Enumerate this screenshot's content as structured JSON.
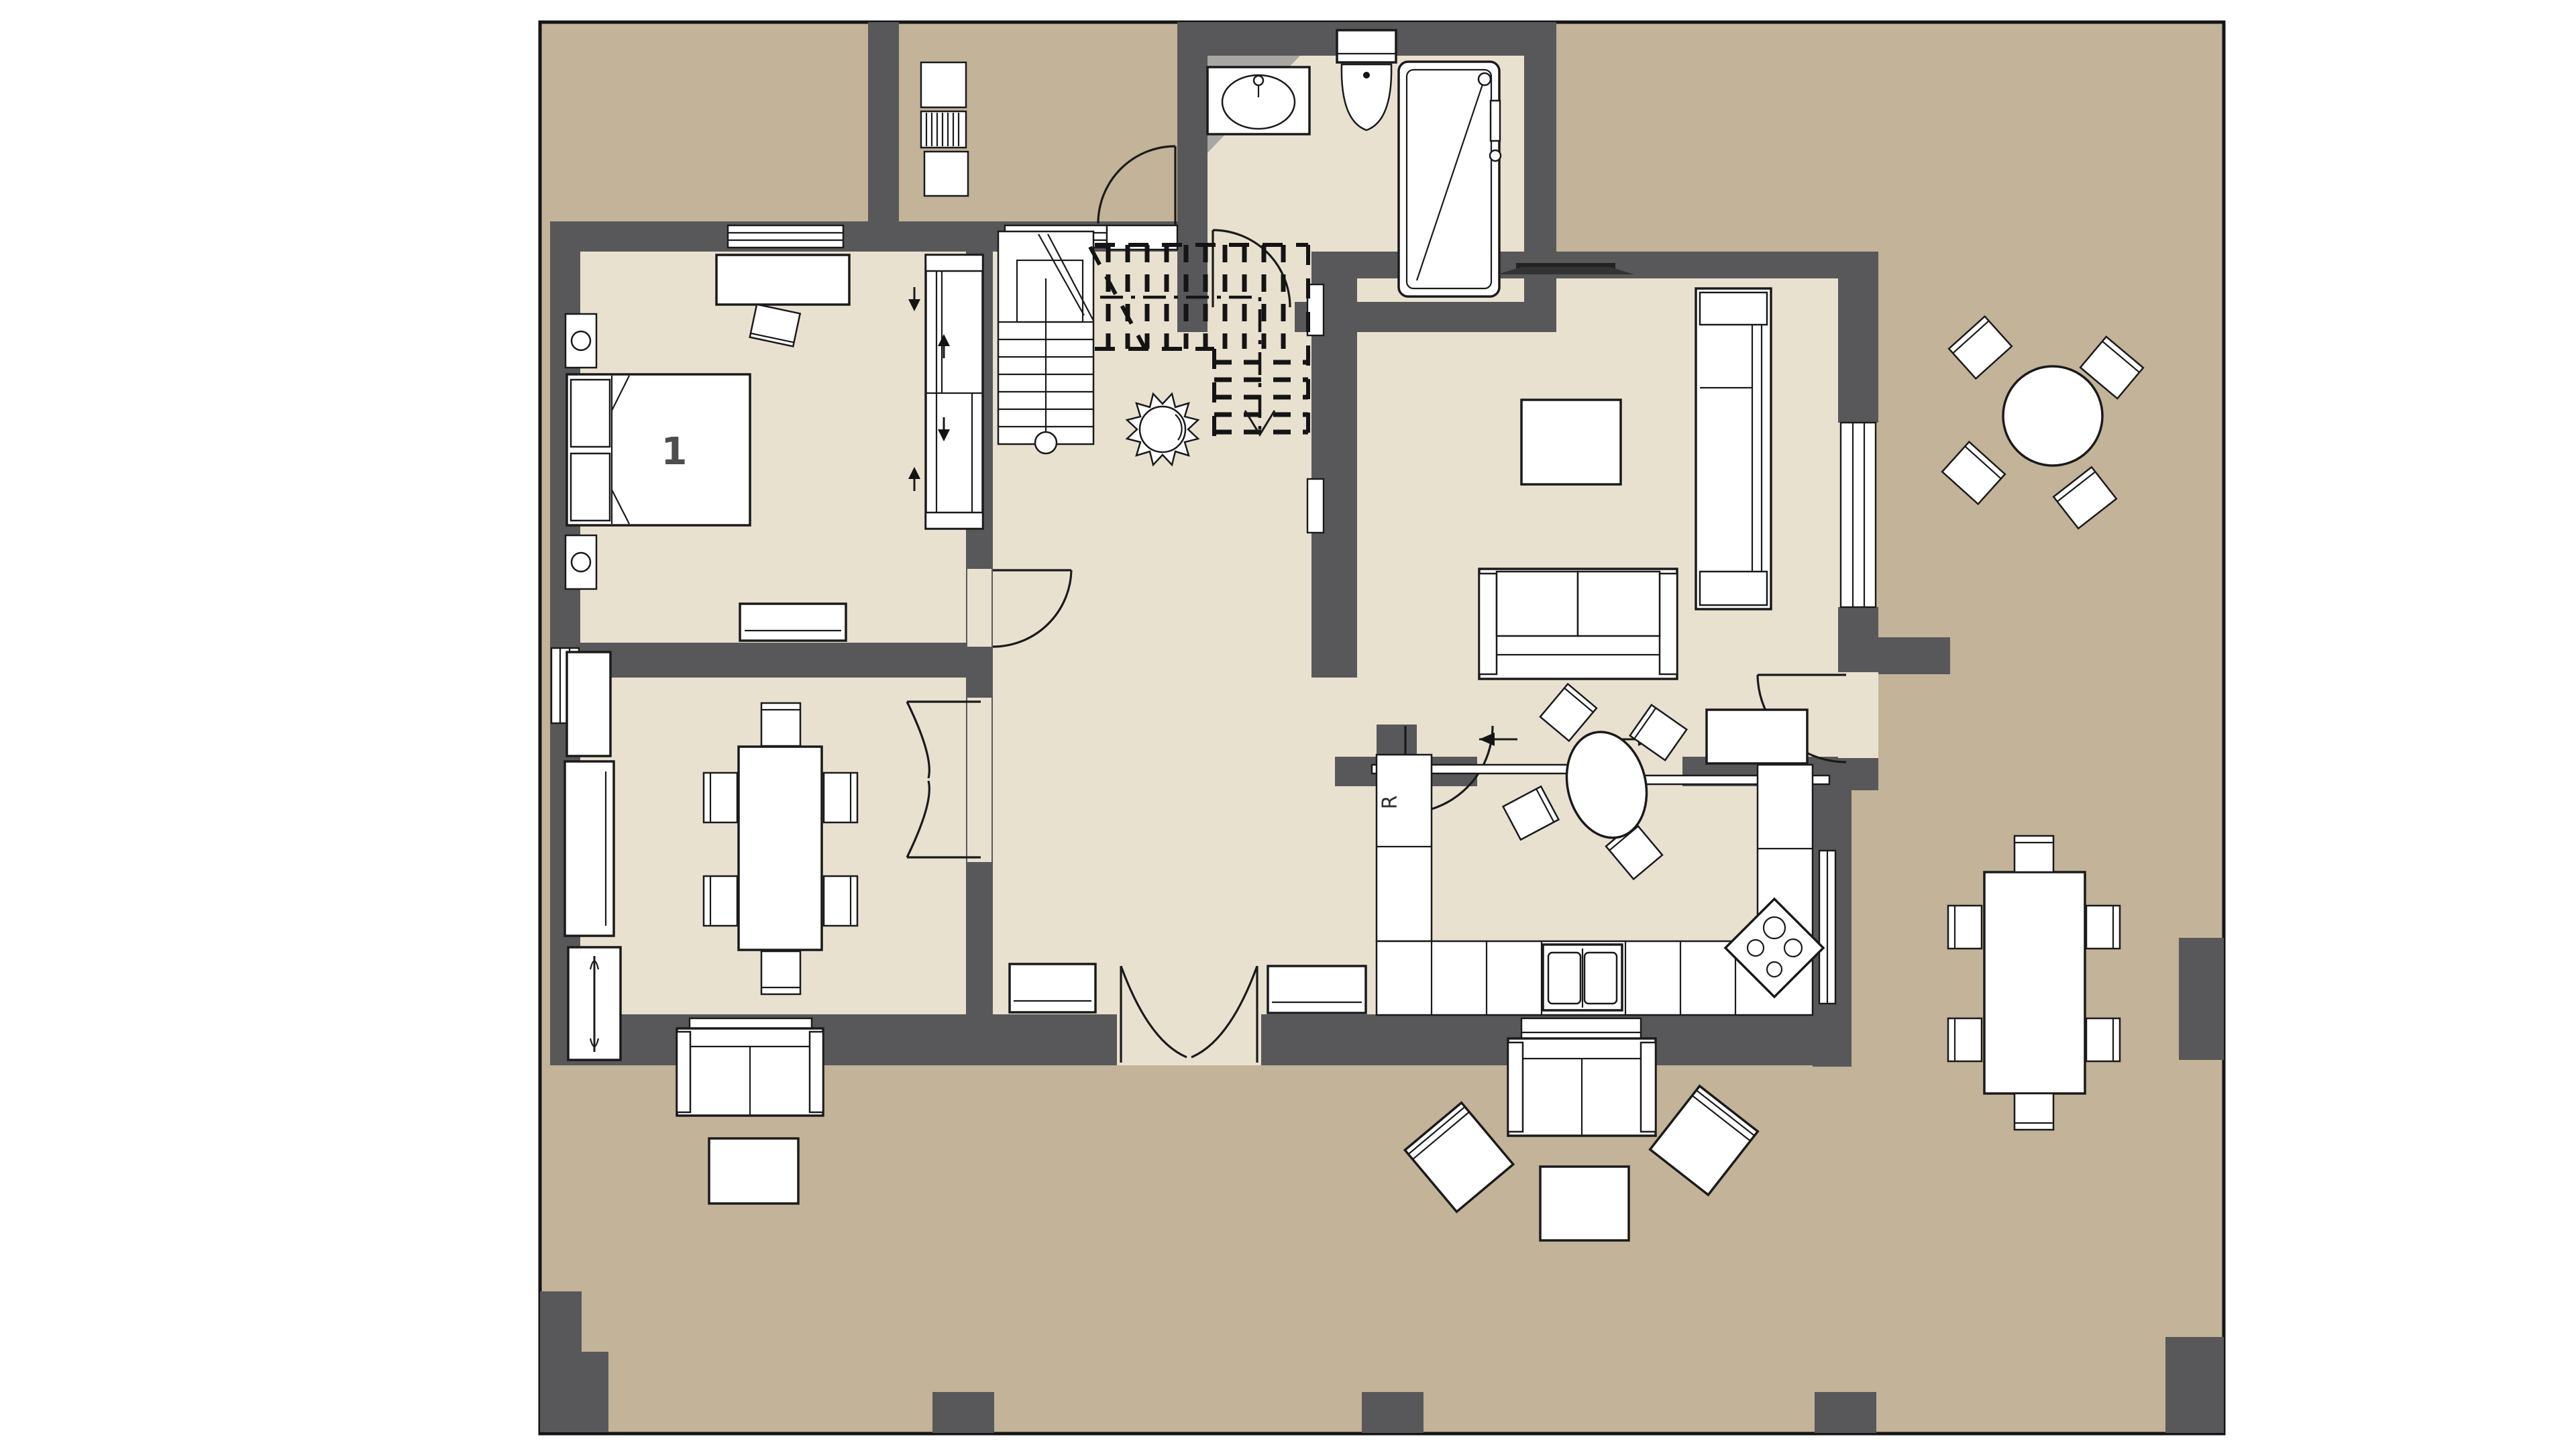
{
  "document": {
    "type": "architectural-floor-plan",
    "floor": "ground-floor",
    "background": "#ffffff"
  },
  "palette": {
    "outdoor_terrace": "#c2b399",
    "indoor_floor": "#e9e1d0",
    "wall": "#58585a",
    "furniture_fill": "#ffffff",
    "line": "#1a1a1a"
  },
  "labels": {
    "bedroom_number": "1",
    "refrigerator": "R"
  },
  "symbols": {
    "wardrobe_arrows": [
      "arrow-down",
      "arrow-up",
      "arrow-down",
      "arrow-up"
    ],
    "sliding_door_arrows": [
      "arrow-left",
      "arrow-right"
    ],
    "stair_run_arrow": "arrow-down",
    "plant_symbol": "potted-plant",
    "shower_symbol": "shower-with-diagonal",
    "stove_symbol": "diamond-cooktop-4-burners"
  },
  "rooms": [
    {
      "name": "bedroom-1",
      "label": "1",
      "furniture": [
        "double-bed",
        "two-nightstands-with-lamps",
        "desk",
        "desk-chair",
        "dresser",
        "sliding-wardrobe"
      ]
    },
    {
      "name": "bathroom",
      "furniture": [
        "vanity-sink",
        "toilet",
        "shower"
      ]
    },
    {
      "name": "hallway",
      "furniture": [
        "staircase",
        "plant",
        "bench",
        "bench"
      ]
    },
    {
      "name": "living-room",
      "furniture": [
        "tv",
        "coffee-table",
        "chaise-sofa",
        "two-seat-sofa",
        "side-table"
      ]
    },
    {
      "name": "dining-room",
      "furniture": [
        "dining-table",
        "six-chairs",
        "sideboard",
        "cabinet",
        "radiator-cabinet"
      ]
    },
    {
      "name": "kitchen",
      "furniture": [
        "refrigerator",
        "l-shaped-counter",
        "double-sink",
        "cooktop",
        "round-table",
        "four-chairs"
      ]
    },
    {
      "name": "terrace-north",
      "furniture": [
        "round-table",
        "four-chairs"
      ]
    },
    {
      "name": "terrace-east",
      "furniture": [
        "outdoor-dining-table",
        "six-chairs"
      ]
    },
    {
      "name": "terrace-south",
      "furniture": [
        "outdoor-sofa",
        "two-armchairs",
        "coffee-table",
        "outdoor-sofa",
        "coffee-table"
      ]
    },
    {
      "name": "porch",
      "furniture": [
        "utility-cabinet",
        "vent-grille",
        "utility-box"
      ]
    }
  ]
}
